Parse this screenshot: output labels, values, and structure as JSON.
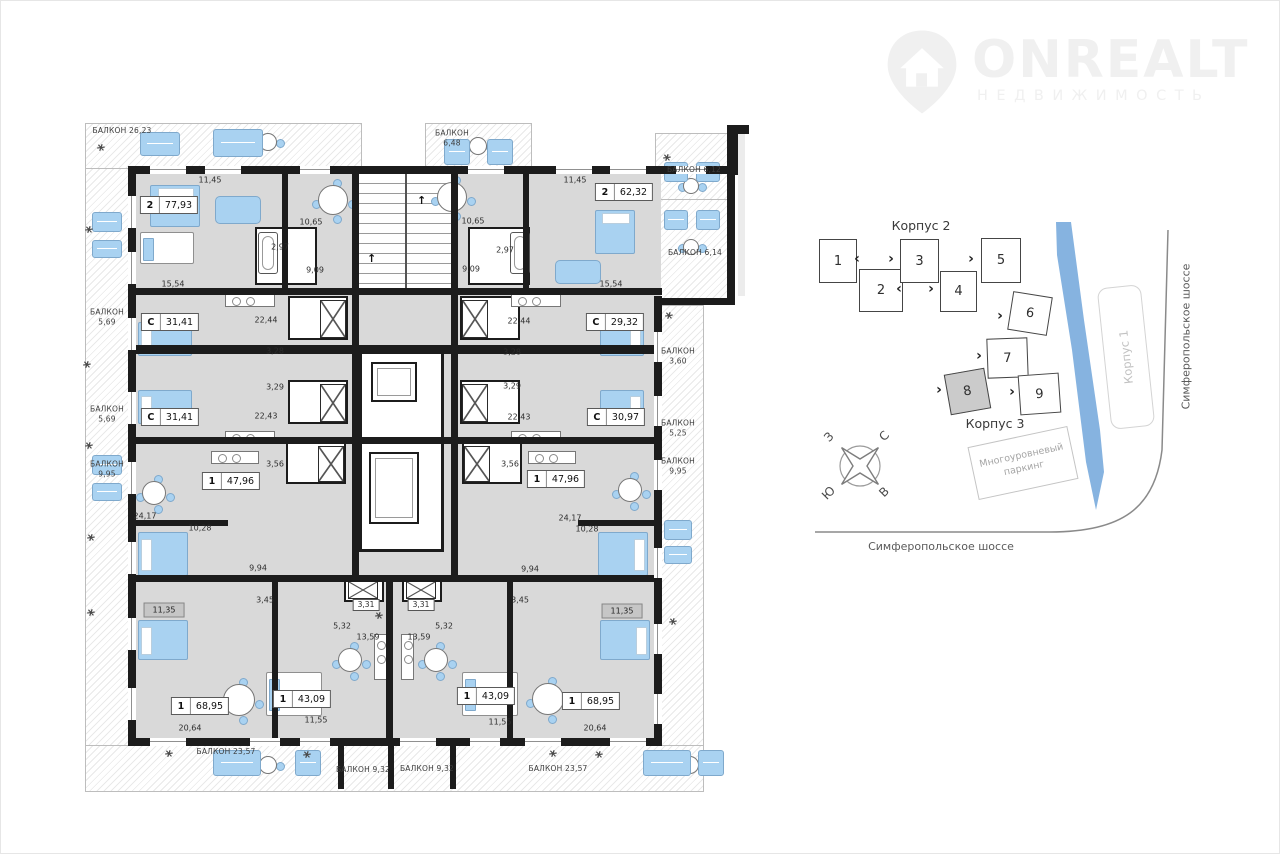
{
  "logo": {
    "brand": "ONREALT",
    "subtitle": "НЕДВИЖИМОСТЬ"
  },
  "floorplan": {
    "apartments": [
      {
        "type": "2",
        "area": "77,93",
        "x": 169,
        "y": 205
      },
      {
        "type": "2",
        "area": "62,32",
        "x": 624,
        "y": 192
      },
      {
        "type": "С",
        "area": "31,41",
        "x": 170,
        "y": 322
      },
      {
        "type": "С",
        "area": "31,41",
        "x": 170,
        "y": 417
      },
      {
        "type": "С",
        "area": "29,32",
        "x": 615,
        "y": 322
      },
      {
        "type": "С",
        "area": "30,97",
        "x": 616,
        "y": 417
      },
      {
        "type": "1",
        "area": "47,96",
        "x": 231,
        "y": 481
      },
      {
        "type": "1",
        "area": "47,96",
        "x": 556,
        "y": 479
      },
      {
        "type": "1",
        "area": "68,95",
        "x": 200,
        "y": 706
      },
      {
        "type": "1",
        "area": "43,09",
        "x": 302,
        "y": 699
      },
      {
        "type": "1",
        "area": "43,09",
        "x": 486,
        "y": 696
      },
      {
        "type": "1",
        "area": "68,95",
        "x": 591,
        "y": 701
      }
    ],
    "dimensions": [
      {
        "t": "11,45",
        "x": 210,
        "y": 180
      },
      {
        "t": "11,45",
        "x": 575,
        "y": 180
      },
      {
        "t": "10,65",
        "x": 311,
        "y": 222
      },
      {
        "t": "10,65",
        "x": 473,
        "y": 221
      },
      {
        "t": "2,97",
        "x": 280,
        "y": 247
      },
      {
        "t": "2,97",
        "x": 505,
        "y": 250
      },
      {
        "t": "9,09",
        "x": 315,
        "y": 270
      },
      {
        "t": "9,09",
        "x": 471,
        "y": 269
      },
      {
        "t": "15,54",
        "x": 173,
        "y": 284
      },
      {
        "t": "15,54",
        "x": 611,
        "y": 284
      },
      {
        "t": "22,44",
        "x": 266,
        "y": 320
      },
      {
        "t": "22,44",
        "x": 519,
        "y": 321
      },
      {
        "t": "3,28",
        "x": 275,
        "y": 351
      },
      {
        "t": "3,28",
        "x": 512,
        "y": 352
      },
      {
        "t": "3,29",
        "x": 275,
        "y": 387
      },
      {
        "t": "3,29",
        "x": 512,
        "y": 386
      },
      {
        "t": "22,43",
        "x": 266,
        "y": 416
      },
      {
        "t": "22,43",
        "x": 519,
        "y": 417
      },
      {
        "t": "3,56",
        "x": 275,
        "y": 464
      },
      {
        "t": "3,56",
        "x": 510,
        "y": 464
      },
      {
        "t": "24,17",
        "x": 145,
        "y": 516
      },
      {
        "t": "24,17",
        "x": 570,
        "y": 518
      },
      {
        "t": "10,28",
        "x": 200,
        "y": 528
      },
      {
        "t": "10,28",
        "x": 587,
        "y": 529
      },
      {
        "t": "9,94",
        "x": 258,
        "y": 568
      },
      {
        "t": "9,94",
        "x": 530,
        "y": 569
      },
      {
        "t": "3,45",
        "x": 265,
        "y": 600
      },
      {
        "t": "3,45",
        "x": 520,
        "y": 600
      },
      {
        "t": "5,32",
        "x": 342,
        "y": 626
      },
      {
        "t": "5,32",
        "x": 444,
        "y": 626
      },
      {
        "t": "13,59",
        "x": 368,
        "y": 637
      },
      {
        "t": "13,59",
        "x": 419,
        "y": 637
      },
      {
        "t": "11,55",
        "x": 316,
        "y": 720
      },
      {
        "t": "11,55",
        "x": 500,
        "y": 722
      },
      {
        "t": "20,64",
        "x": 190,
        "y": 728
      },
      {
        "t": "20,64",
        "x": 595,
        "y": 728
      }
    ],
    "boxed_dimensions": [
      {
        "t": "3,31",
        "x": 366,
        "y": 605
      },
      {
        "t": "3,31",
        "x": 421,
        "y": 605
      }
    ],
    "gray_rooms": [
      {
        "t": "11,35",
        "x": 164,
        "y": 610
      },
      {
        "t": "11,35",
        "x": 622,
        "y": 611
      }
    ],
    "balconies": [
      {
        "label": "БАЛКОН 26,23",
        "x": 122,
        "y": 131
      },
      {
        "label": "БАЛКОН",
        "value": "6,48",
        "x": 452,
        "y": 138
      },
      {
        "label": "БАЛКОН 6,12",
        "x": 694,
        "y": 170
      },
      {
        "label": "БАЛКОН 6,14",
        "x": 695,
        "y": 253
      },
      {
        "label": "БАЛКОН",
        "value": "5,69",
        "x": 107,
        "y": 317
      },
      {
        "label": "БАЛКОН",
        "value": "5,69",
        "x": 107,
        "y": 414
      },
      {
        "label": "БАЛКОН",
        "value": "9,95",
        "x": 107,
        "y": 469
      },
      {
        "label": "БАЛКОН",
        "value": "3,60",
        "x": 678,
        "y": 356
      },
      {
        "label": "БАЛКОН",
        "value": "5,25",
        "x": 678,
        "y": 428
      },
      {
        "label": "БАЛКОН",
        "value": "9,95",
        "x": 678,
        "y": 466
      },
      {
        "label": "БАЛКОН 23,57",
        "x": 226,
        "y": 752
      },
      {
        "label": "БАЛКОН 9,32",
        "x": 363,
        "y": 770
      },
      {
        "label": "БАЛКОН 9,32",
        "x": 427,
        "y": 769
      },
      {
        "label": "БАЛКОН 23,57",
        "x": 558,
        "y": 769
      }
    ]
  },
  "sitemap": {
    "korpus2_label": "Корпус 2",
    "korpus3_label": "Корпус 3",
    "korpus1_label": "Корпус 1",
    "parking_line1": "Многоуровневый",
    "parking_line2": "паркинг",
    "highway_label": "Симферопольское шоссе",
    "buildings": [
      {
        "num": "1",
        "x": 819,
        "y": 239,
        "w": 38,
        "h": 44,
        "rot": 0,
        "selected": false
      },
      {
        "num": "2",
        "x": 859,
        "y": 269,
        "w": 44,
        "h": 43,
        "rot": 0,
        "selected": false
      },
      {
        "num": "3",
        "x": 900,
        "y": 239,
        "w": 39,
        "h": 44,
        "rot": 0,
        "selected": false
      },
      {
        "num": "4",
        "x": 940,
        "y": 271,
        "w": 37,
        "h": 41,
        "rot": 0,
        "selected": false
      },
      {
        "num": "5",
        "x": 981,
        "y": 238,
        "w": 40,
        "h": 45,
        "rot": 0,
        "selected": false
      },
      {
        "num": "6",
        "x": 1010,
        "y": 294,
        "w": 40,
        "h": 39,
        "rot": 9,
        "selected": false
      },
      {
        "num": "7",
        "x": 987,
        "y": 338,
        "w": 41,
        "h": 40,
        "rot": -2,
        "selected": false
      },
      {
        "num": "8",
        "x": 947,
        "y": 371,
        "w": 41,
        "h": 41,
        "rot": -10,
        "selected": true
      },
      {
        "num": "9",
        "x": 1019,
        "y": 374,
        "w": 41,
        "h": 40,
        "rot": -4,
        "selected": false
      }
    ],
    "chevrons": [
      {
        "g": "‹",
        "x": 857,
        "y": 259
      },
      {
        "g": "›",
        "x": 891,
        "y": 259
      },
      {
        "g": "›",
        "x": 971,
        "y": 259
      },
      {
        "g": "‹",
        "x": 899,
        "y": 289
      },
      {
        "g": "›",
        "x": 931,
        "y": 289
      },
      {
        "g": "›",
        "x": 1000,
        "y": 316
      },
      {
        "g": "›",
        "x": 979,
        "y": 356
      },
      {
        "g": "›",
        "x": 939,
        "y": 390
      },
      {
        "g": "›",
        "x": 1012,
        "y": 392
      }
    ],
    "compass": {
      "top_left": "З",
      "top_right": "С",
      "bottom_left": "Ю",
      "bottom_right": "В"
    }
  }
}
